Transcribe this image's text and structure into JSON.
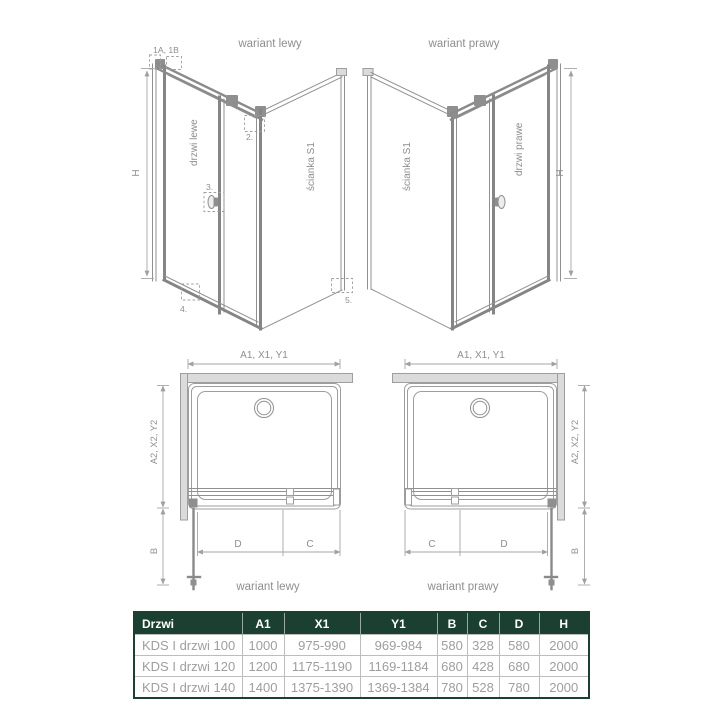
{
  "colors": {
    "accent_green": "#1b4032",
    "table_header_text": "#ffffff",
    "table_cell_text": "#9e9e9e",
    "line_gray": "#8f8f8f",
    "wall_fill": "#dbdbdb"
  },
  "left3d": {
    "title": "wariant lewy",
    "door_label": "drzwi lewe",
    "wall_label": "ścianka S1",
    "dim_h": "H",
    "callout_1": "1A, 1B",
    "callout_2": "2.",
    "callout_3": "3.",
    "callout_4": "4.",
    "callout_5": "5."
  },
  "right3d": {
    "title": "wariant prawy",
    "door_label": "drzwi prawe",
    "wall_label": "ścianka S1",
    "dim_h": "H"
  },
  "plan_left": {
    "caption": "wariant lewy",
    "dim_width": "A1, X1, Y1",
    "dim_depth": "A2, X2, Y2",
    "dim_b": "B",
    "dim_d": "D",
    "dim_c": "C"
  },
  "plan_right": {
    "caption": "wariant prawy",
    "dim_width": "A1, X1, Y1",
    "dim_depth": "A2, X2, Y2",
    "dim_b": "B",
    "dim_c": "C",
    "dim_d": "D"
  },
  "table": {
    "headers": [
      "Drzwi",
      "A1",
      "X1",
      "Y1",
      "B",
      "C",
      "D",
      "H"
    ],
    "rows": [
      {
        "name": "KDS I drzwi 100",
        "a1": "1000",
        "x1": "975-990",
        "y1": "969-984",
        "b": "580",
        "c": "328",
        "d": "580",
        "h": "2000"
      },
      {
        "name": "KDS I drzwi 120",
        "a1": "1200",
        "x1": "1175-1190",
        "y1": "1169-1184",
        "b": "680",
        "c": "428",
        "d": "680",
        "h": "2000"
      },
      {
        "name": "KDS I drzwi 140",
        "a1": "1400",
        "x1": "1375-1390",
        "y1": "1369-1384",
        "b": "780",
        "c": "528",
        "d": "780",
        "h": "2000"
      }
    ]
  }
}
